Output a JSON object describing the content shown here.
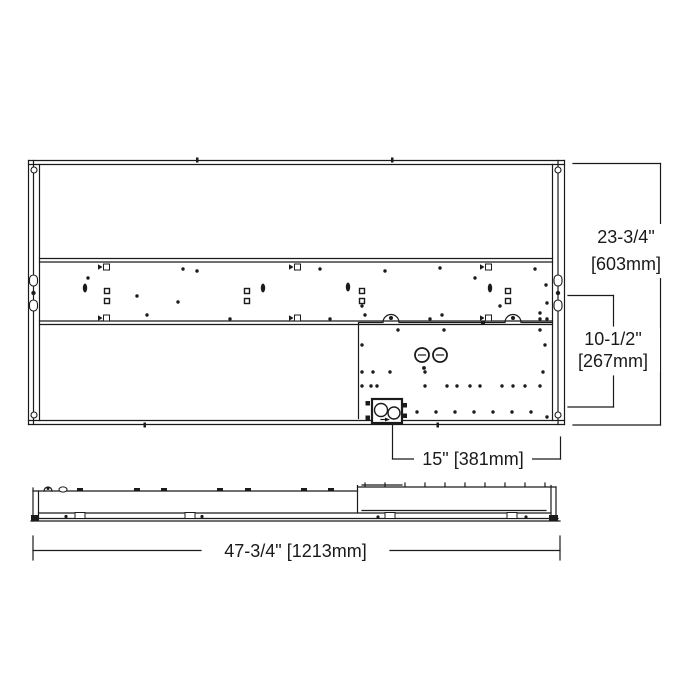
{
  "colors": {
    "line": "#1b1b1b",
    "background": "#ffffff",
    "text": "#1a1a1a"
  },
  "dimensions": {
    "fixture_height": {
      "imperial": "23-3/4\"",
      "metric": "[603mm]"
    },
    "driver_channel_height": {
      "imperial": "10-1/2\"",
      "metric": "[267mm]"
    },
    "junction_box_offset": {
      "label": "15\" [381mm]"
    },
    "fixture_length": {
      "label": "47-3/4\" [1213mm]"
    }
  }
}
